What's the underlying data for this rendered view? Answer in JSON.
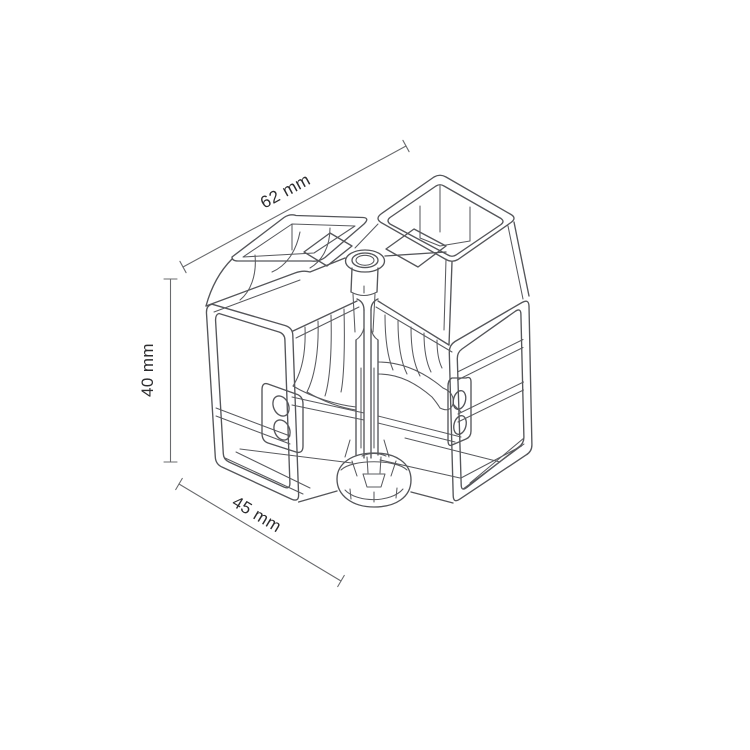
{
  "figure": {
    "type": "isometric technical line drawing",
    "subject": "corner-connector-wireframe",
    "background_color": "#ffffff",
    "line_color": "#55565a",
    "text_color": "#2d2d2f"
  },
  "dimensions": {
    "width": {
      "label": "62 mm",
      "value": 62,
      "unit": "mm"
    },
    "height": {
      "label": "40 mm",
      "value": 40,
      "unit": "mm"
    },
    "depth": {
      "label": "45 mm",
      "value": 45,
      "unit": "mm"
    }
  }
}
